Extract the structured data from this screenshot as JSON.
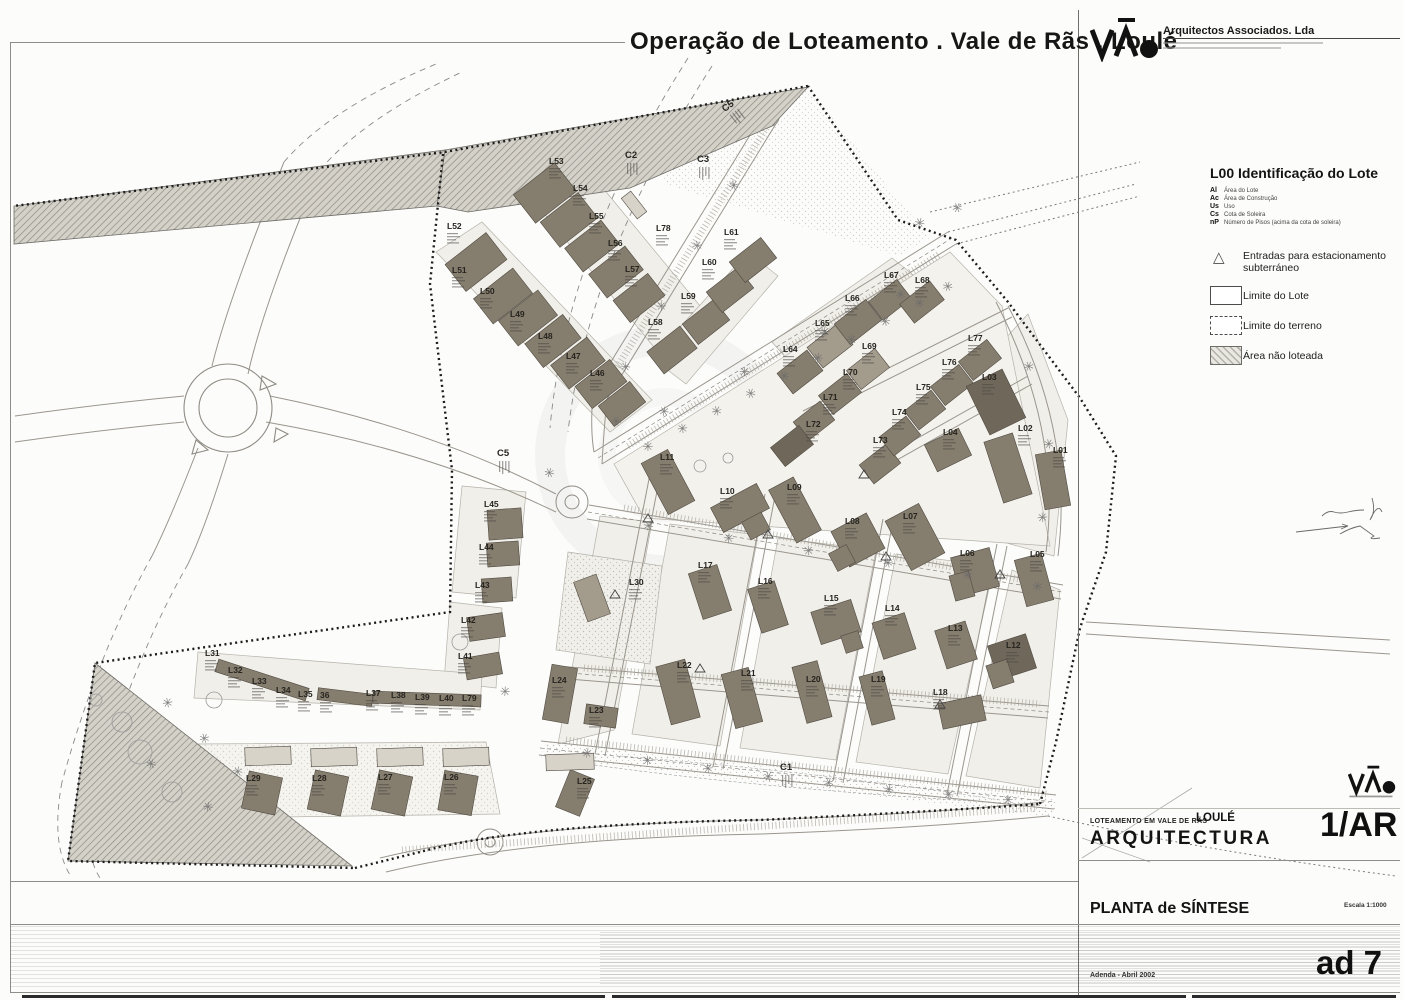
{
  "title": "Operação de Loteamento . Vale de Rãs . Loulé",
  "logo": {
    "mark": "VÃO",
    "firm": "Arquitectos Associados. Lda"
  },
  "legend": {
    "heading": "L00 Identificação do Lote",
    "abbrevs": [
      {
        "k": "Al",
        "v": "Área do Lote"
      },
      {
        "k": "Ac",
        "v": "Área de Construção"
      },
      {
        "k": "Us",
        "v": "Uso"
      },
      {
        "k": "Cs",
        "v": "Cota de Soleira"
      },
      {
        "k": "nP",
        "v": "Número de Pisos (acima da cota de soleira)"
      }
    ],
    "entries": [
      {
        "label": "Entradas para estacionamento subterráneo"
      },
      {
        "label": "Limite do Lote"
      },
      {
        "label": "Limite do terreno"
      },
      {
        "label": "Área não loteada"
      }
    ]
  },
  "titleblock": {
    "project": "LOTEAMENTO EM VALE DE RÃS",
    "city": "LOULÉ",
    "discipline": "ARQUITECTURA",
    "sheet": "1/AR",
    "drawing": "PLANTA de SÍNTESE",
    "scale": "Escala 1:1000",
    "revision": "ad 7",
    "note": "Adenda - Abril 2002"
  },
  "colors": {
    "building_dark": "#857d6e",
    "building_darker": "#6f675a",
    "building_mid": "#a39b8c",
    "building_light": "#d8d3c8",
    "line": "#9a968e",
    "boundary": "#1c1c1c"
  },
  "plan": {
    "lots": [
      [
        "L52",
        447,
        222,
        476,
        262,
        52,
        34,
        -38
      ],
      [
        "L51",
        452,
        266,
        503,
        296,
        50,
        32,
        -38
      ],
      [
        "L50",
        480,
        287,
        528,
        318,
        50,
        32,
        -38
      ],
      [
        "L49",
        510,
        310,
        553,
        341,
        48,
        30,
        -38
      ],
      [
        "L48",
        538,
        332,
        578,
        363,
        46,
        30,
        -38
      ],
      [
        "L47",
        566,
        352,
        601,
        384,
        44,
        28,
        -38
      ],
      [
        "L46",
        590,
        369,
        622,
        404,
        40,
        26,
        -38
      ],
      [
        "L53",
        549,
        157,
        545,
        193,
        52,
        36,
        -38
      ],
      [
        "L54",
        573,
        184,
        569,
        220,
        48,
        32,
        -38
      ],
      [
        "L55",
        589,
        212,
        592,
        246,
        46,
        30,
        -38
      ],
      [
        "L56",
        608,
        239,
        616,
        272,
        46,
        30,
        -38
      ],
      [
        "L57",
        625,
        265,
        639,
        298,
        44,
        28,
        -38
      ],
      [
        "L58",
        648,
        318,
        672,
        350,
        42,
        28,
        -38
      ],
      [
        "L59",
        681,
        292,
        706,
        322,
        40,
        26,
        -38
      ],
      [
        "L60",
        702,
        258,
        730,
        290,
        40,
        26,
        -38
      ],
      [
        "L61",
        724,
        228,
        753,
        260,
        40,
        26,
        -38
      ],
      [
        "L78",
        656,
        224,
        0,
        0,
        0,
        0,
        0
      ],
      [
        "L64",
        783,
        345,
        800,
        372,
        38,
        26,
        -38
      ],
      [
        "L65",
        815,
        319,
        830,
        346,
        38,
        26,
        -38,
        "m"
      ],
      [
        "L66",
        845,
        294,
        858,
        322,
        40,
        26,
        -38
      ],
      [
        "L67",
        884,
        271,
        890,
        300,
        36,
        24,
        -38
      ],
      [
        "L68",
        915,
        276,
        922,
        302,
        38,
        24,
        -38
      ],
      [
        "L69",
        862,
        342,
        868,
        369,
        36,
        24,
        -38,
        "m"
      ],
      [
        "L70",
        843,
        368,
        840,
        394,
        36,
        24,
        -38
      ],
      [
        "L71",
        823,
        393,
        814,
        421,
        34,
        24,
        -38
      ],
      [
        "L72",
        806,
        420,
        792,
        446,
        36,
        24,
        -38,
        "x"
      ],
      [
        "L73",
        873,
        436,
        880,
        464,
        34,
        24,
        -38
      ],
      [
        "L74",
        892,
        408,
        900,
        436,
        34,
        24,
        -38
      ],
      [
        "L75",
        916,
        383,
        925,
        410,
        34,
        24,
        -38
      ],
      [
        "L76",
        942,
        358,
        952,
        385,
        36,
        24,
        -38
      ],
      [
        "L77",
        968,
        334,
        980,
        360,
        36,
        24,
        -38
      ],
      [
        "L03",
        982,
        373,
        996,
        402,
        40,
        54,
        -26,
        "x"
      ],
      [
        "L04",
        943,
        428,
        948,
        450,
        38,
        30,
        -26
      ],
      [
        "L02",
        1018,
        424,
        1008,
        468,
        30,
        64,
        -18
      ],
      [
        "L01",
        1053,
        446,
        1053,
        480,
        26,
        56,
        -10
      ],
      [
        "L05",
        1030,
        550,
        1034,
        580,
        28,
        48,
        -15
      ],
      [
        "L06",
        960,
        549,
        975,
        572,
        40,
        40,
        -15
      ],
      [
        "L11",
        660,
        453,
        668,
        482,
        30,
        58,
        -28
      ],
      [
        "L10",
        720,
        487,
        740,
        508,
        52,
        28,
        -28
      ],
      [
        "L09",
        787,
        483,
        795,
        510,
        28,
        60,
        -28
      ],
      [
        "L08",
        845,
        517,
        858,
        540,
        40,
        40,
        -28
      ],
      [
        "L07",
        903,
        512,
        915,
        537,
        38,
        56,
        -28
      ],
      [
        "L17",
        698,
        561,
        710,
        592,
        30,
        48,
        -18
      ],
      [
        "L16",
        758,
        577,
        768,
        607,
        28,
        46,
        -18
      ],
      [
        "L15",
        824,
        594,
        836,
        622,
        42,
        34,
        -18
      ],
      [
        "L14",
        885,
        604,
        894,
        636,
        34,
        38,
        -18
      ],
      [
        "L13",
        948,
        624,
        956,
        645,
        32,
        40,
        -18
      ],
      [
        "L12",
        1006,
        641,
        1012,
        657,
        40,
        36,
        -18,
        "x"
      ],
      [
        "L24",
        552,
        676,
        560,
        694,
        26,
        56,
        10
      ],
      [
        "L23",
        589,
        706,
        601,
        716,
        32,
        20,
        8
      ],
      [
        "L22",
        677,
        661,
        678,
        692,
        30,
        60,
        -15
      ],
      [
        "L21",
        741,
        669,
        742,
        698,
        28,
        56,
        -15
      ],
      [
        "L20",
        806,
        675,
        812,
        692,
        26,
        58,
        -15
      ],
      [
        "L19",
        871,
        675,
        877,
        698,
        24,
        50,
        -15
      ],
      [
        "L18",
        933,
        688,
        962,
        712,
        44,
        26,
        -12
      ],
      [
        "L25",
        577,
        777,
        575,
        793,
        26,
        40,
        22
      ],
      [
        "L30",
        629,
        578,
        592,
        598,
        24,
        42,
        -20,
        "m"
      ],
      [
        "L45",
        484,
        500,
        505,
        524,
        34,
        30,
        -4
      ],
      [
        "L44",
        479,
        543,
        503,
        554,
        32,
        24,
        -4
      ],
      [
        "L43",
        475,
        581,
        497,
        590,
        30,
        24,
        -4
      ],
      [
        "L42",
        461,
        616,
        486,
        627,
        36,
        24,
        -8
      ],
      [
        "L41",
        458,
        652,
        483,
        666,
        36,
        22,
        -10
      ],
      [
        "L31",
        205,
        649,
        0,
        0,
        0,
        0,
        0
      ],
      [
        "L32",
        228,
        666,
        0,
        0,
        0,
        0,
        0
      ],
      [
        "L33",
        252,
        677,
        0,
        0,
        0,
        0,
        0
      ],
      [
        "L34",
        276,
        686,
        0,
        0,
        0,
        0,
        0
      ],
      [
        "L35",
        298,
        690,
        0,
        0,
        0,
        0,
        0
      ],
      [
        "36",
        320,
        691,
        0,
        0,
        0,
        0,
        0
      ],
      [
        "L37",
        366,
        689,
        0,
        0,
        0,
        0,
        0
      ],
      [
        "L38",
        391,
        691,
        0,
        0,
        0,
        0,
        0
      ],
      [
        "L39",
        415,
        693,
        0,
        0,
        0,
        0,
        0
      ],
      [
        "L40",
        439,
        694,
        0,
        0,
        0,
        0,
        0
      ],
      [
        "L79",
        462,
        694,
        0,
        0,
        0,
        0,
        0
      ],
      [
        "L29",
        246,
        774,
        262,
        793,
        34,
        38,
        12
      ],
      [
        "L28",
        312,
        774,
        328,
        793,
        34,
        40,
        12
      ],
      [
        "L27",
        378,
        773,
        392,
        793,
        34,
        40,
        12
      ],
      [
        "L26",
        444,
        773,
        458,
        793,
        34,
        40,
        10
      ]
    ],
    "extras": [
      [
        262,
        680,
        95,
        13,
        18
      ],
      [
        345,
        697,
        55,
        12,
        7
      ],
      [
        427,
        699,
        108,
        12,
        2
      ],
      [
        268,
        756,
        46,
        18,
        -2,
        "l"
      ],
      [
        334,
        757,
        46,
        18,
        -2,
        "l"
      ],
      [
        400,
        757,
        46,
        18,
        -2,
        "l"
      ],
      [
        466,
        757,
        46,
        18,
        -2,
        "l"
      ],
      [
        570,
        762,
        48,
        16,
        -2,
        "l"
      ],
      [
        634,
        205,
        12,
        26,
        -38,
        "l"
      ],
      [
        756,
        526,
        22,
        20,
        -28
      ],
      [
        842,
        558,
        20,
        20,
        -28
      ],
      [
        962,
        586,
        20,
        26,
        -15
      ],
      [
        1000,
        674,
        22,
        24,
        -18
      ],
      [
        852,
        642,
        18,
        18,
        -18
      ]
    ],
    "clabels": [
      [
        "C1",
        780,
        762,
        0
      ],
      [
        "C2",
        625,
        150,
        0
      ],
      [
        "C3",
        697,
        154,
        0
      ],
      [
        "C5",
        720,
        106,
        -38
      ],
      [
        "C5",
        497,
        448,
        0
      ]
    ],
    "trees": [
      [
        648,
        447
      ],
      [
        682,
        429
      ],
      [
        716,
        411
      ],
      [
        750,
        393
      ],
      [
        784,
        375
      ],
      [
        818,
        357
      ],
      [
        852,
        339
      ],
      [
        886,
        321
      ],
      [
        920,
        303
      ],
      [
        948,
        287
      ],
      [
        664,
        412
      ],
      [
        744,
        372
      ],
      [
        824,
        332
      ],
      [
        900,
        294
      ],
      [
        957,
        207
      ],
      [
        920,
        222
      ],
      [
        626,
        366
      ],
      [
        662,
        306
      ],
      [
        698,
        246
      ],
      [
        734,
        186
      ],
      [
        616,
        422
      ],
      [
        648,
        526
      ],
      [
        728,
        538
      ],
      [
        808,
        550
      ],
      [
        888,
        562
      ],
      [
        968,
        574
      ],
      [
        1038,
        586
      ],
      [
        588,
        753
      ],
      [
        648,
        761
      ],
      [
        708,
        769
      ],
      [
        768,
        777
      ],
      [
        828,
        783
      ],
      [
        888,
        789
      ],
      [
        948,
        794
      ],
      [
        1008,
        799
      ],
      [
        168,
        702
      ],
      [
        205,
        738
      ],
      [
        152,
        764
      ],
      [
        238,
        772
      ],
      [
        505,
        692
      ],
      [
        1042,
        518
      ],
      [
        1048,
        444
      ],
      [
        1028,
        366
      ],
      [
        549,
        472
      ],
      [
        208,
        806
      ]
    ],
    "shrubs": [
      [
        122,
        722,
        10
      ],
      [
        140,
        752,
        12
      ],
      [
        172,
        792,
        10
      ],
      [
        460,
        642,
        8
      ],
      [
        700,
        466,
        6
      ],
      [
        728,
        458,
        5
      ],
      [
        214,
        700,
        8
      ],
      [
        96,
        700,
        6
      ]
    ],
    "entrances": [
      [
        648,
        514
      ],
      [
        768,
        530
      ],
      [
        886,
        552
      ],
      [
        1000,
        570
      ],
      [
        700,
        664
      ],
      [
        940,
        700
      ],
      [
        615,
        590
      ],
      [
        864,
        470
      ]
    ]
  }
}
